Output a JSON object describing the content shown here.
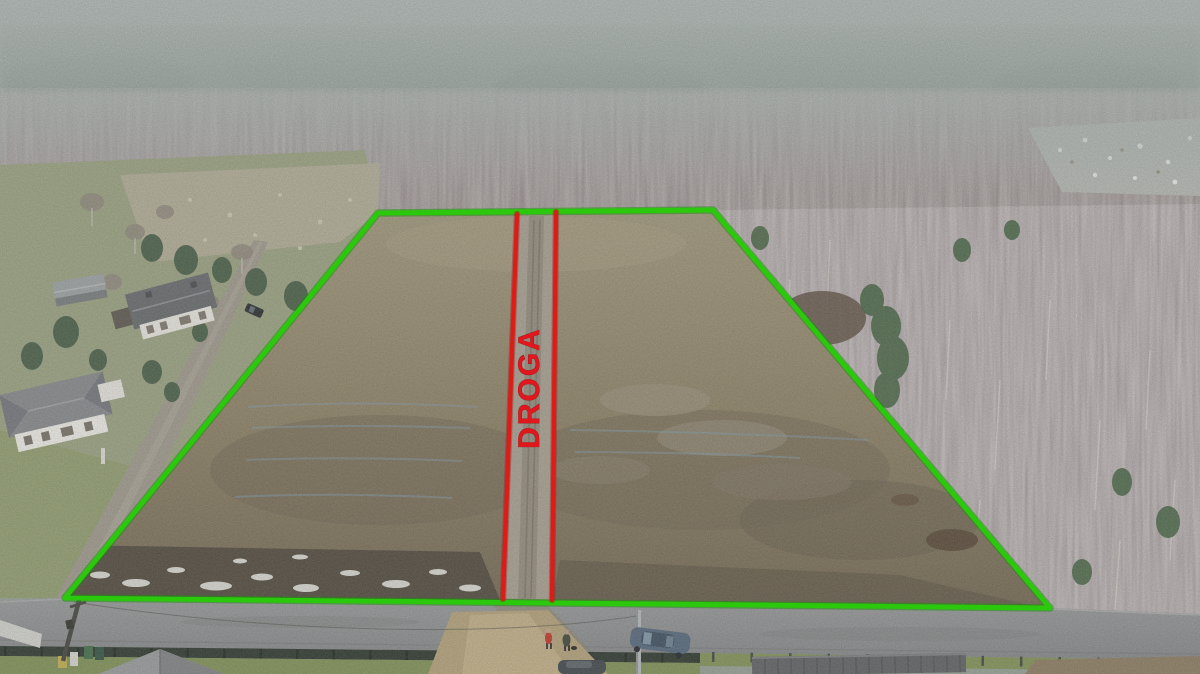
{
  "annotations": {
    "road_label": "DROGA",
    "boundary_color": "#2bc90b",
    "divider_color": "#dd1b17",
    "label_color": "#e0171c"
  },
  "scene": {
    "type": "aerial-drone-photo",
    "counts": {
      "houses": 2,
      "parked_cars": 3,
      "people": 2,
      "utility_poles": 2
    }
  }
}
